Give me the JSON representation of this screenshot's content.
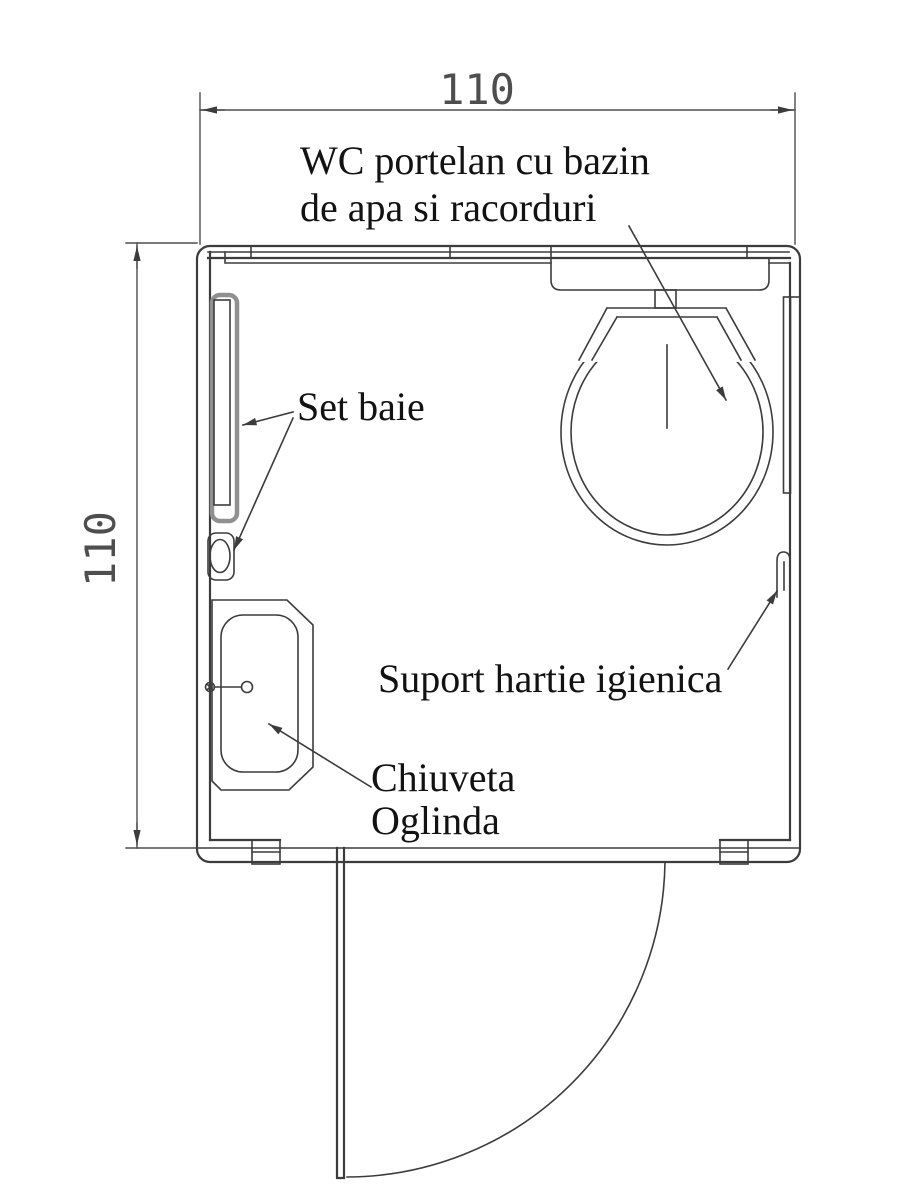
{
  "drawing": {
    "kind": "bathroom floor plan (technical CAD drawing)",
    "dimensions": {
      "top_width_label": "110",
      "left_height_label": "110"
    },
    "annotations": {
      "toilet_line1": "WC portelan cu bazin",
      "toilet_line2": "de apa si racorduri",
      "bath_set_label": "Set baie",
      "paper_holder_label": "Suport hartie igienica",
      "sink_label_line1": "Chiuveta",
      "sink_label_line2": "Oglinda"
    },
    "colors": {
      "line": "#3c3c3c",
      "panel": "#909090",
      "text": "#121212",
      "dim": "#4e4e4e",
      "bg": "#ffffff"
    }
  }
}
